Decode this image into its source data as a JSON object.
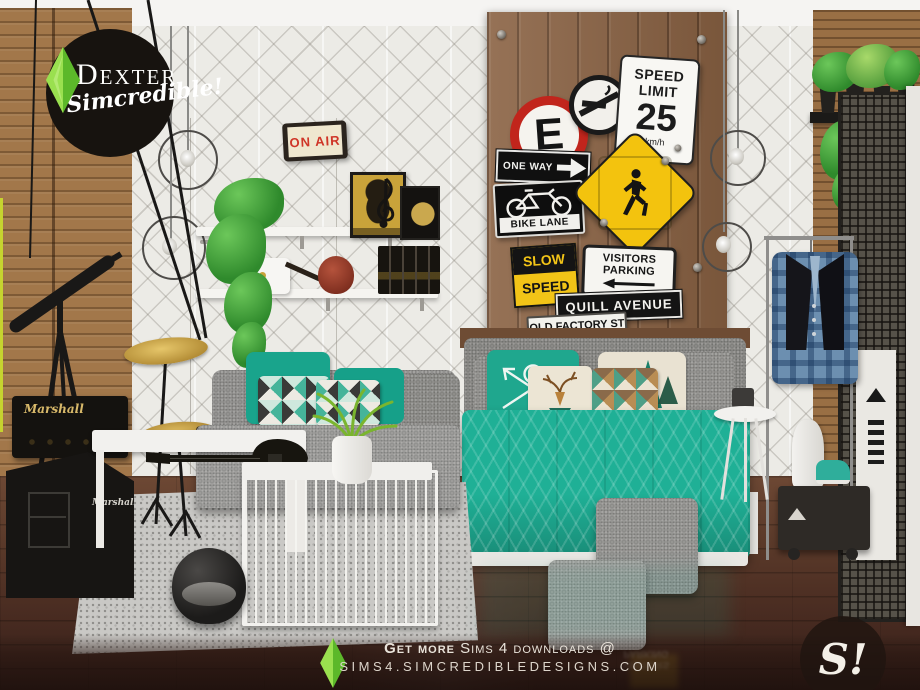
{
  "branding": {
    "title": "DEXTER",
    "subtitle": "Simcredible!",
    "badge": "S!"
  },
  "signs": {
    "on_air": "ON AIR",
    "no_parking": "E",
    "speed_limit": {
      "line1": "SPEED",
      "line2": "LIMIT",
      "value": "25",
      "unit": "km/h"
    },
    "one_way": "ONE WAY",
    "bike_lane": "BIKE LANE",
    "slow": {
      "line1": "SLOW",
      "line2": "SPEED"
    },
    "visitors": {
      "line1": "VISITORS",
      "line2": "PARKING"
    },
    "street_top": "QUILL AVENUE",
    "street_bottom": "OLD FACTORY ST"
  },
  "amp": {
    "brand": "Marshall"
  },
  "footer": {
    "line1_bold": "Get more",
    "line1_rest": " Sims 4 downloads @",
    "line2": "SIMS4.SIMCREDIBLEDESIGNS.COM"
  },
  "colors": {
    "teal_accent": "#1fb096",
    "plumbob_green": "#8ed73a",
    "sign_yellow": "#f2c417",
    "sign_red": "#c1251c",
    "wood_panel": "#8a6243"
  }
}
